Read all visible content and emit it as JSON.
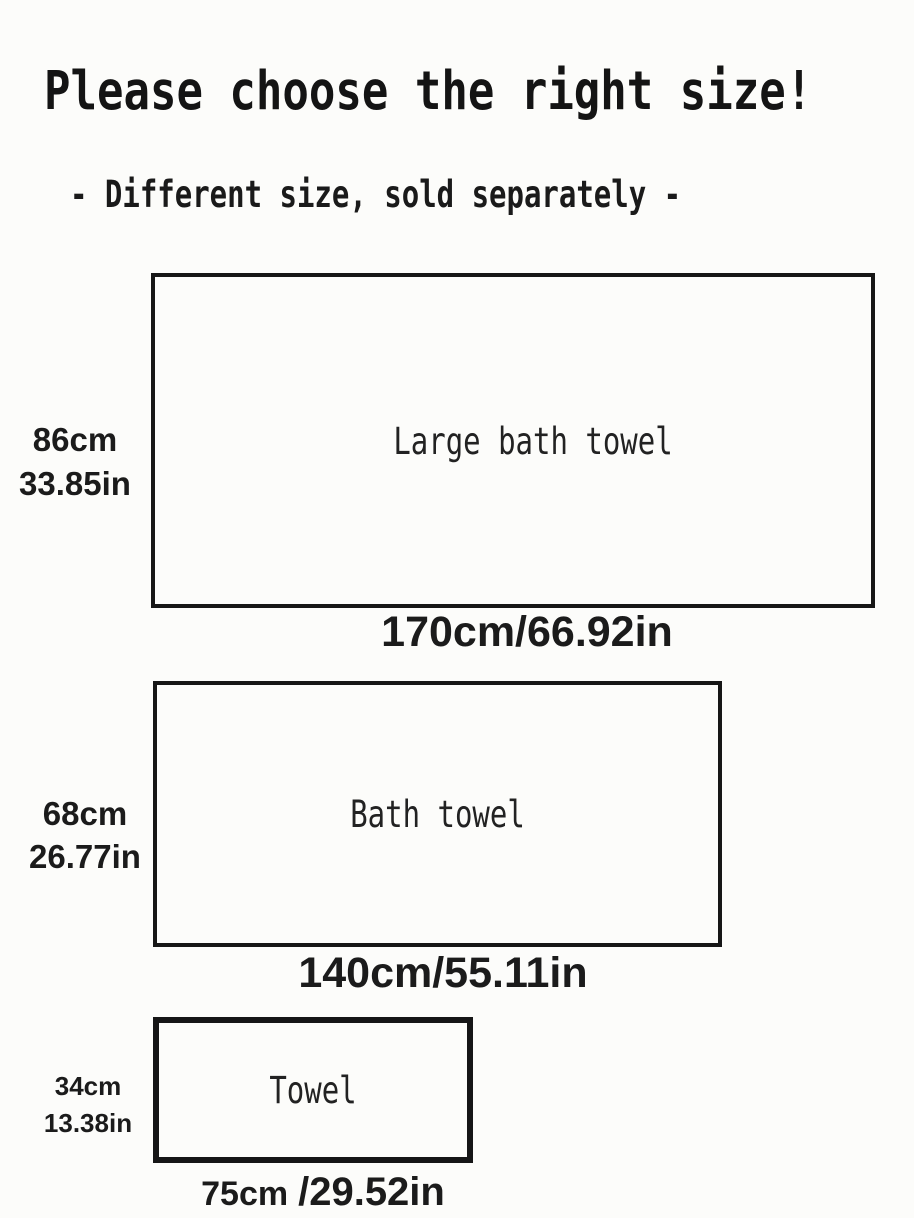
{
  "page": {
    "title": "Please choose the right size!",
    "subtitle": "- Different size, sold separately -",
    "background_color": "#fcfcfa",
    "ink_color": "#161616"
  },
  "towels": [
    {
      "name": "Large bath towel",
      "height_cm": "86cm",
      "height_in": "33.85in",
      "width_label": "170cm/66.92in"
    },
    {
      "name": "Bath towel",
      "height_cm": "68cm",
      "height_in": "26.77in",
      "width_label": "140cm/55.11in"
    },
    {
      "name": "Towel",
      "height_cm": "34cm",
      "height_in": "13.38in",
      "width_label_cm": "75cm",
      "width_label_in": "/29.52in"
    }
  ],
  "chart_data": {
    "type": "table",
    "title": "Please choose the right size!",
    "subtitle": "- Different size, sold separately -",
    "columns": [
      "name",
      "width_cm",
      "width_in",
      "height_cm",
      "height_in"
    ],
    "rows": [
      [
        "Large bath towel",
        170,
        66.92,
        86,
        33.85
      ],
      [
        "Bath towel",
        140,
        55.11,
        68,
        26.77
      ],
      [
        "Towel",
        75,
        29.52,
        34,
        13.38
      ]
    ]
  }
}
